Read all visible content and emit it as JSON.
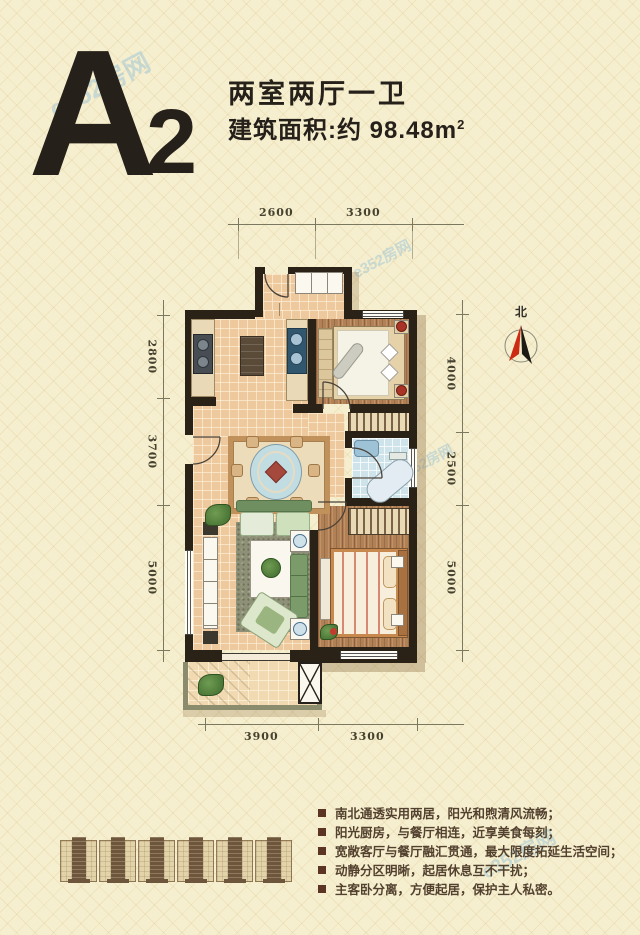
{
  "header": {
    "unit_letter": "A",
    "unit_number": "2",
    "layout_type": "两室两厅一卫",
    "area_label": "建筑面积:约 98.48m",
    "area_sup": "2"
  },
  "compass": {
    "north_label": "北"
  },
  "dimensions": {
    "top": [
      "2600",
      "3300"
    ],
    "left": [
      "2800",
      "3700",
      "5000"
    ],
    "right": [
      "4000",
      "2500",
      "5000"
    ],
    "bottom": [
      "3900",
      "3300"
    ]
  },
  "features": [
    "南北通透实用两居，阳光和煦清风流畅；",
    "阳光厨房，与餐厅相连，近享美食每刻；",
    "宽敞客厅与餐厅融汇贯通，最大限度拓延生活空间；",
    "动静分区明晰，起居休息互不干扰；",
    "主客卧分离，方便起居，保护主人私密。"
  ],
  "watermark": {
    "text": "e352房网"
  },
  "colors": {
    "background": "#f6efcf",
    "wall": "#2a2117",
    "compass_red": "#cc2a12",
    "title_text": "#26201a",
    "bullet": "#5c3423"
  }
}
